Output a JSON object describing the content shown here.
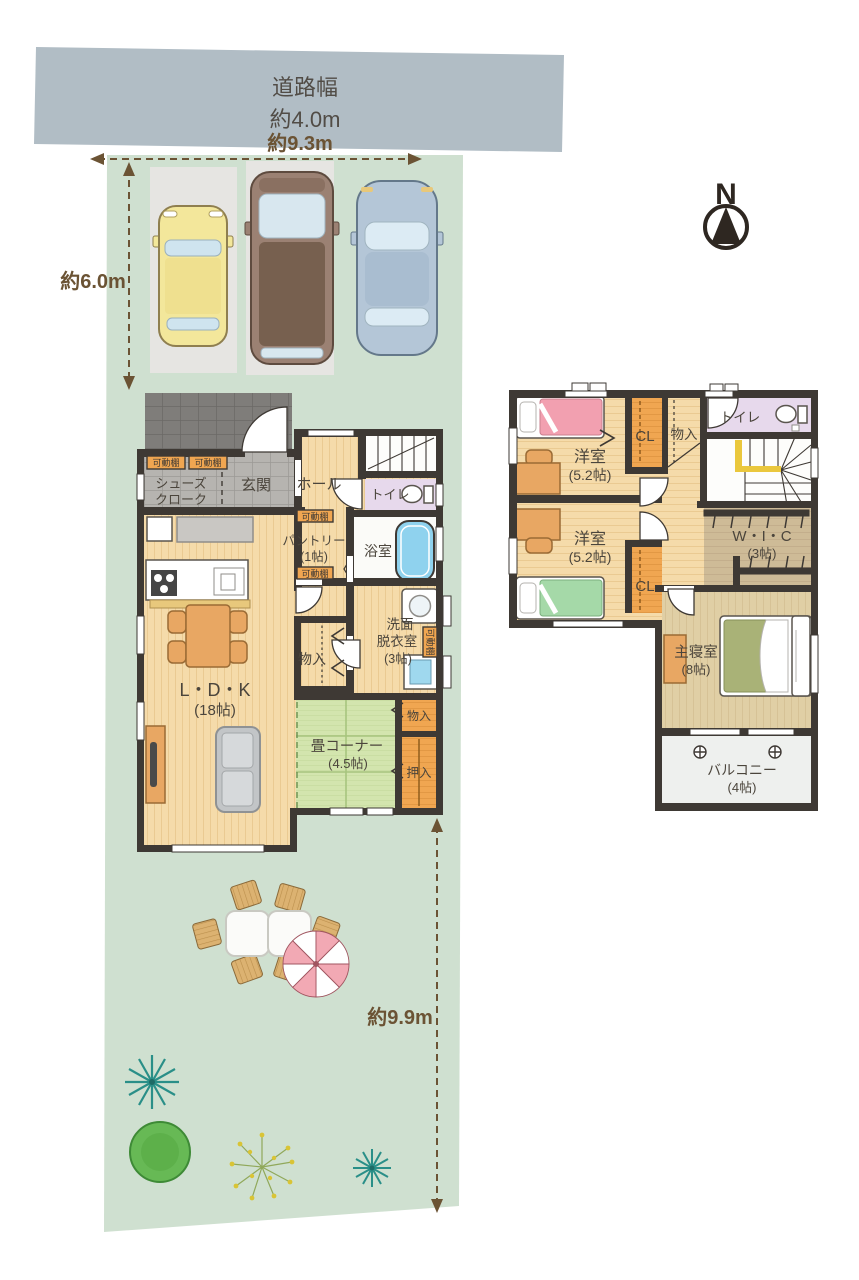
{
  "site": {
    "road": {
      "line1": "道路幅",
      "line2": "約4.0m"
    },
    "dimensions": {
      "frontage": "約9.3m",
      "west_depth": "約6.0m",
      "east_depth": "約9.9m"
    },
    "compass": {
      "north": "N"
    }
  },
  "floor1": {
    "badges": {
      "movable_shelf": "可動棚"
    },
    "rooms": {
      "shoes_closet": {
        "line1": "シューズ",
        "line2": "クローク"
      },
      "genkan": {
        "label": "玄関"
      },
      "hall": {
        "label": "ホール"
      },
      "toilet": {
        "label": "トイレ"
      },
      "bath": {
        "label": "浴室"
      },
      "pantry": {
        "line1": "パントリー",
        "line2": "(1帖)"
      },
      "washroom": {
        "line1": "洗面",
        "line2": "脱衣室",
        "line3": "(3帖)"
      },
      "storage": {
        "label": "物入"
      },
      "ldk": {
        "line1": "L・D・K",
        "line2": "(18帖)"
      },
      "tatami": {
        "line1": "畳コーナー",
        "line2": "(4.5帖)"
      },
      "tatami_storage": {
        "label": "物入"
      },
      "oshiire": {
        "label": "押入"
      }
    }
  },
  "floor2": {
    "rooms": {
      "bedroom1": {
        "line1": "洋室",
        "line2": "(5.2帖)"
      },
      "bedroom2": {
        "line1": "洋室",
        "line2": "(5.2帖)"
      },
      "closet1": {
        "label": "CL"
      },
      "closet2": {
        "label": "CL"
      },
      "storage": {
        "label": "物入"
      },
      "toilet": {
        "label": "トイレ"
      },
      "wic": {
        "line1": "W・I・C",
        "line2": "(3帖)"
      },
      "master": {
        "line1": "主寝室",
        "line2": "(8帖)"
      },
      "balcony": {
        "line1": "バルコニー",
        "line2": "(4帖)"
      }
    }
  },
  "colors": {
    "road_gray": "#b1bdc5",
    "lot_green": "#cfe0d0",
    "wall": "#3e3934",
    "wood_floor": "#f5dbaa",
    "tatami_green": "#d3e5ae",
    "closet_orange": "#f0a651",
    "toilet_purple": "#e7d9ec",
    "tub_blue": "#8fd2ee",
    "dimension_brown": "#6b5334"
  }
}
